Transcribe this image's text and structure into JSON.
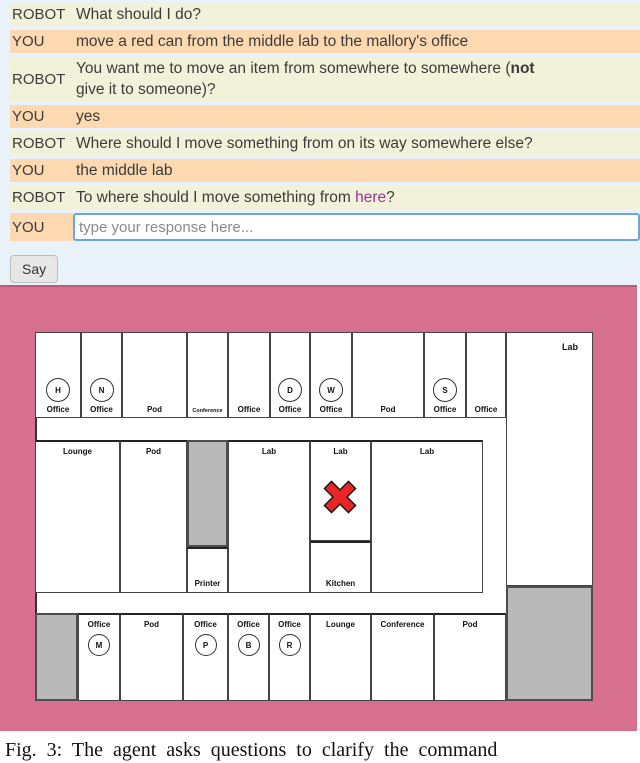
{
  "chat": {
    "rows": [
      {
        "speaker": "ROBOT",
        "segments": [
          {
            "t": "What should I do?"
          }
        ]
      },
      {
        "speaker": "YOU",
        "segments": [
          {
            "t": "move a red can from the middle lab to the mallory's office"
          }
        ]
      },
      {
        "speaker": "ROBOT",
        "segments": [
          {
            "t": "You want me to move an item from somewhere to somewhere ("
          },
          {
            "t": "not",
            "style": "bold"
          },
          {
            "br": true
          },
          {
            "t": "give it to someone)?"
          }
        ]
      },
      {
        "speaker": "YOU",
        "segments": [
          {
            "t": "yes"
          }
        ]
      },
      {
        "speaker": "ROBOT",
        "segments": [
          {
            "t": "Where should I move something from on its way somewhere else?"
          }
        ]
      },
      {
        "speaker": "YOU",
        "segments": [
          {
            "t": "the middle lab"
          }
        ]
      },
      {
        "speaker": "ROBOT",
        "segments": [
          {
            "t": "To where should I move something from "
          },
          {
            "t": "here",
            "style": "link"
          },
          {
            "t": "?"
          }
        ]
      }
    ],
    "input_row": {
      "speaker": "YOU",
      "placeholder": "type your response here..."
    },
    "say_label": "Say"
  },
  "map": {
    "rooms": [
      {
        "name": "room-office-h",
        "band": "top",
        "x": 35,
        "y": 45,
        "w": 46,
        "h": 86,
        "label": "Office",
        "letter": "H"
      },
      {
        "name": "room-office-n",
        "band": "top",
        "x": 81,
        "y": 45,
        "w": 41,
        "h": 86,
        "label": "Office",
        "letter": "N"
      },
      {
        "name": "room-pod-top1",
        "band": "top",
        "x": 122,
        "y": 45,
        "w": 65,
        "h": 86,
        "label": "Pod"
      },
      {
        "name": "room-conference-top",
        "band": "top",
        "x": 187,
        "y": 45,
        "w": 41,
        "h": 86,
        "label": "Conference",
        "labelClass": "small"
      },
      {
        "name": "room-office-top5",
        "band": "top",
        "x": 228,
        "y": 45,
        "w": 42,
        "h": 86,
        "label": "Office"
      },
      {
        "name": "room-office-d",
        "band": "top",
        "x": 270,
        "y": 45,
        "w": 40,
        "h": 86,
        "label": "Office",
        "letter": "D"
      },
      {
        "name": "room-office-w",
        "band": "top",
        "x": 310,
        "y": 45,
        "w": 42,
        "h": 86,
        "label": "Office",
        "letter": "W"
      },
      {
        "name": "room-pod-top2",
        "band": "top",
        "x": 352,
        "y": 45,
        "w": 72,
        "h": 86,
        "label": "Pod"
      },
      {
        "name": "room-office-s",
        "band": "top",
        "x": 424,
        "y": 45,
        "w": 42,
        "h": 86,
        "label": "Office",
        "letter": "S"
      },
      {
        "name": "room-office-top10",
        "band": "top",
        "x": 466,
        "y": 45,
        "w": 40,
        "h": 86,
        "label": "Office"
      },
      {
        "name": "room-lab-big",
        "band": "top",
        "x": 506,
        "y": 45,
        "w": 87,
        "h": 254,
        "label": "Lab",
        "labelClass": "corner"
      },
      {
        "name": "room-lounge-mid",
        "band": "mid",
        "x": 35,
        "y": 153,
        "w": 85,
        "h": 153,
        "label": "Lounge"
      },
      {
        "name": "room-pod-mid",
        "band": "mid",
        "x": 120,
        "y": 153,
        "w": 67,
        "h": 153,
        "label": "Pod"
      },
      {
        "name": "block-stairs-mid",
        "band": "mid",
        "x": 187,
        "y": 153,
        "w": 41,
        "h": 107,
        "fill": "gray"
      },
      {
        "name": "room-printer",
        "band": "mid",
        "x": 187,
        "y": 260,
        "w": 41,
        "h": 46,
        "label": "Printer",
        "labelClass": "low"
      },
      {
        "name": "room-lab-left",
        "band": "mid",
        "x": 228,
        "y": 153,
        "w": 82,
        "h": 153,
        "label": "Lab"
      },
      {
        "name": "room-lab-middle",
        "band": "mid",
        "x": 310,
        "y": 153,
        "w": 61,
        "h": 101,
        "label": "Lab"
      },
      {
        "name": "room-kitchen",
        "band": "mid",
        "x": 310,
        "y": 254,
        "w": 61,
        "h": 52,
        "label": "Kitchen",
        "labelClass": "low"
      },
      {
        "name": "room-lab-right",
        "band": "mid",
        "x": 371,
        "y": 153,
        "w": 112,
        "h": 153,
        "label": "Lab"
      },
      {
        "name": "block-stairs-left",
        "band": "bottom",
        "x": 35,
        "y": 326,
        "w": 43,
        "h": 88,
        "fill": "gray"
      },
      {
        "name": "room-office-m",
        "band": "bottom",
        "x": 78,
        "y": 326,
        "w": 42,
        "h": 88,
        "label": "Office",
        "letter": "M"
      },
      {
        "name": "room-pod-bottom1",
        "band": "bottom",
        "x": 120,
        "y": 326,
        "w": 63,
        "h": 88,
        "label": "Pod"
      },
      {
        "name": "room-office-p",
        "band": "bottom",
        "x": 183,
        "y": 326,
        "w": 45,
        "h": 88,
        "label": "Office",
        "letter": "P"
      },
      {
        "name": "room-office-b",
        "band": "bottom",
        "x": 228,
        "y": 326,
        "w": 41,
        "h": 88,
        "label": "Office",
        "letter": "B"
      },
      {
        "name": "room-office-r",
        "band": "bottom",
        "x": 269,
        "y": 326,
        "w": 41,
        "h": 88,
        "label": "Office",
        "letter": "R"
      },
      {
        "name": "room-lounge-bottom",
        "band": "bottom",
        "x": 310,
        "y": 326,
        "w": 61,
        "h": 88,
        "label": "Lounge"
      },
      {
        "name": "room-conference-bottom",
        "band": "bottom",
        "x": 371,
        "y": 326,
        "w": 63,
        "h": 88,
        "label": "Conference"
      },
      {
        "name": "room-pod-bottom2",
        "band": "bottom",
        "x": 434,
        "y": 326,
        "w": 72,
        "h": 88,
        "label": "Pod"
      },
      {
        "name": "block-stairs-right",
        "band": "bottom",
        "x": 506,
        "y": 299,
        "w": 87,
        "h": 115,
        "fill": "gray"
      }
    ],
    "marker": {
      "x": 320,
      "y": 190,
      "shape": "red-x"
    }
  },
  "caption": {
    "text": "Fig. 3: The agent asks questions to clarify the command"
  },
  "colors": {
    "chat_bg": "#eaf2f9",
    "robot_row": "#f2f2da",
    "you_row": "#fcd9b0",
    "link": "#993399",
    "input_border": "#6ea5dc",
    "map_bg": "#d7708f",
    "block_gray": "#b9b9b9",
    "marker_red": "#e92525"
  }
}
